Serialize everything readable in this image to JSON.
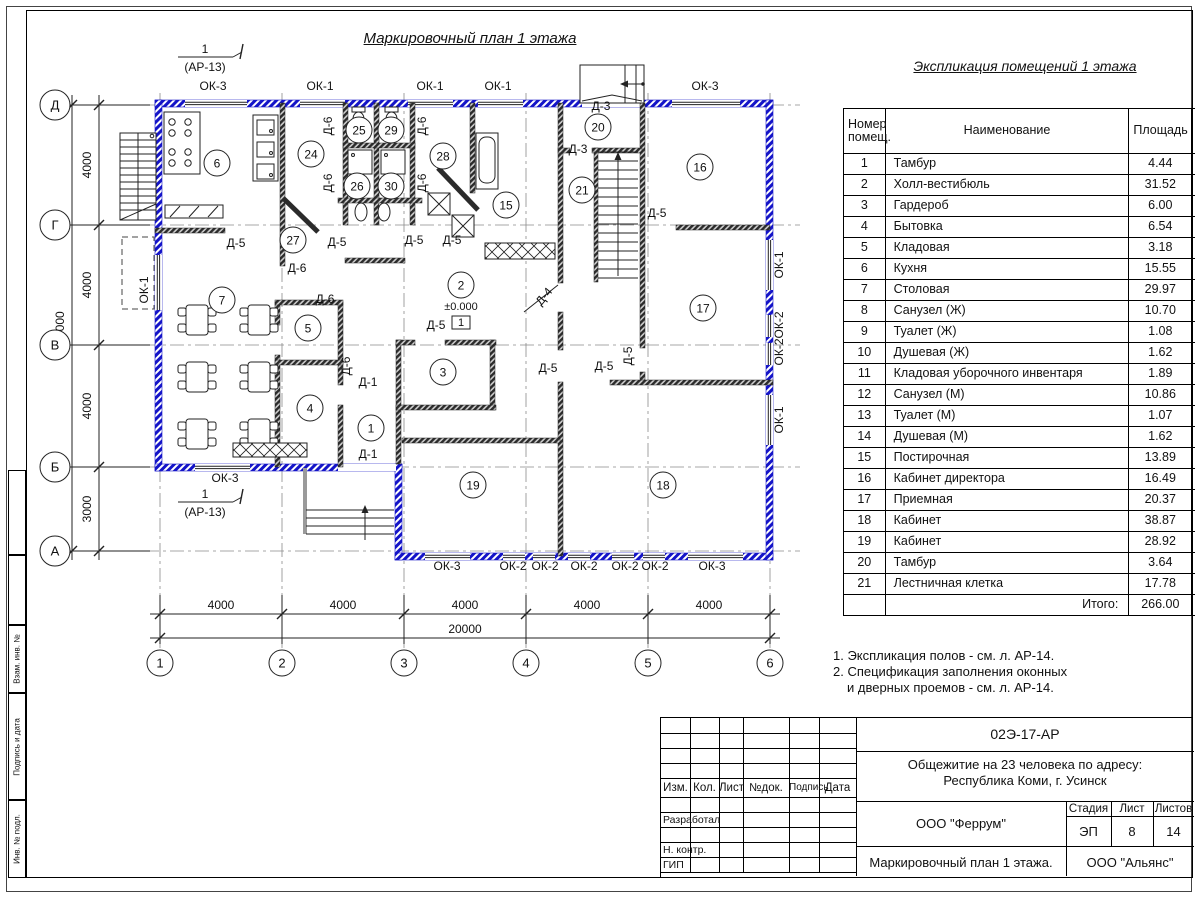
{
  "sheet": {
    "plan_title": "Маркировочный план 1 этажа",
    "section_marker": {
      "num": "1",
      "ref": "(АР-13)"
    }
  },
  "colors": {
    "exterior_wall": "#1414c8",
    "interior_wall": "#2b2b2b"
  },
  "plan": {
    "grid_cols": [
      "1",
      "2",
      "3",
      "4",
      "5",
      "6"
    ],
    "grid_rows": [
      "Д",
      "Г",
      "В",
      "Б",
      "А"
    ],
    "dims_bottom": [
      "4000",
      "4000",
      "4000",
      "4000",
      "4000"
    ],
    "dim_bottom_total": "20000",
    "dims_left": [
      "4000",
      "4000",
      "4000",
      "3000"
    ],
    "dim_left_total": "15000",
    "elevation": "±0.000",
    "floor_type_mark": "1",
    "rooms": [
      {
        "n": "1",
        "x": 371,
        "y": 428
      },
      {
        "n": "2",
        "x": 461,
        "y": 285
      },
      {
        "n": "3",
        "x": 443,
        "y": 372
      },
      {
        "n": "4",
        "x": 310,
        "y": 408
      },
      {
        "n": "5",
        "x": 308,
        "y": 328
      },
      {
        "n": "6",
        "x": 217,
        "y": 163
      },
      {
        "n": "7",
        "x": 222,
        "y": 300
      },
      {
        "n": "15",
        "x": 506,
        "y": 205
      },
      {
        "n": "16",
        "x": 700,
        "y": 167
      },
      {
        "n": "17",
        "x": 703,
        "y": 308
      },
      {
        "n": "18",
        "x": 663,
        "y": 485
      },
      {
        "n": "19",
        "x": 473,
        "y": 485
      },
      {
        "n": "20",
        "x": 598,
        "y": 127
      },
      {
        "n": "21",
        "x": 582,
        "y": 190
      },
      {
        "n": "24",
        "x": 311,
        "y": 154
      },
      {
        "n": "25",
        "x": 359,
        "y": 130
      },
      {
        "n": "26",
        "x": 357,
        "y": 186
      },
      {
        "n": "27",
        "x": 293,
        "y": 240
      },
      {
        "n": "28",
        "x": 443,
        "y": 156
      },
      {
        "n": "29",
        "x": 391,
        "y": 130
      },
      {
        "n": "30",
        "x": 391,
        "y": 186
      }
    ],
    "window_labels": [
      {
        "t": "ОК-3",
        "x": 213,
        "y": 90
      },
      {
        "t": "ОК-1",
        "x": 320,
        "y": 90
      },
      {
        "t": "ОК-1",
        "x": 430,
        "y": 90
      },
      {
        "t": "ОК-1",
        "x": 498,
        "y": 90
      },
      {
        "t": "ОК-3",
        "x": 705,
        "y": 90
      },
      {
        "t": "ОК-3",
        "x": 225,
        "y": 482
      },
      {
        "t": "ОК-3",
        "x": 447,
        "y": 570
      },
      {
        "t": "ОК-2",
        "x": 513,
        "y": 570
      },
      {
        "t": "ОК-2",
        "x": 545,
        "y": 570
      },
      {
        "t": "ОК-2",
        "x": 584,
        "y": 570
      },
      {
        "t": "ОК-2",
        "x": 625,
        "y": 570
      },
      {
        "t": "ОК-2",
        "x": 655,
        "y": 570
      },
      {
        "t": "ОК-3",
        "x": 712,
        "y": 570
      },
      {
        "t": "ОК-1",
        "x": 783,
        "y": 265,
        "r": -90
      },
      {
        "t": "ОК-2",
        "x": 783,
        "y": 325,
        "r": -90
      },
      {
        "t": "ОК-2",
        "x": 783,
        "y": 352,
        "r": -90
      },
      {
        "t": "ОК-1",
        "x": 783,
        "y": 420,
        "r": -90
      },
      {
        "t": "ОК-1",
        "x": 148,
        "y": 290,
        "r": -90
      }
    ],
    "door_labels": [
      {
        "t": "Д-6",
        "x": 332,
        "y": 126,
        "r": -90
      },
      {
        "t": "Д-6",
        "x": 426,
        "y": 126,
        "r": -90
      },
      {
        "t": "Д-6",
        "x": 332,
        "y": 183,
        "r": -90
      },
      {
        "t": "Д-6",
        "x": 426,
        "y": 183,
        "r": -90
      },
      {
        "t": "Д-6",
        "x": 350,
        "y": 366,
        "r": -90
      },
      {
        "t": "Д-6",
        "x": 297,
        "y": 272
      },
      {
        "t": "Д-6",
        "x": 325,
        "y": 303
      },
      {
        "t": "Д-5",
        "x": 236,
        "y": 247
      },
      {
        "t": "Д-5",
        "x": 337,
        "y": 246
      },
      {
        "t": "Д-5",
        "x": 414,
        "y": 244
      },
      {
        "t": "Д-5",
        "x": 452,
        "y": 244
      },
      {
        "t": "Д-5",
        "x": 436,
        "y": 329
      },
      {
        "t": "Д-5",
        "x": 548,
        "y": 372
      },
      {
        "t": "Д-5",
        "x": 604,
        "y": 370
      },
      {
        "t": "Д-5",
        "x": 657,
        "y": 217
      },
      {
        "t": "Д-5",
        "x": 632,
        "y": 356,
        "r": -90
      },
      {
        "t": "Д-3",
        "x": 601,
        "y": 110
      },
      {
        "t": "Д-3",
        "x": 578,
        "y": 153
      },
      {
        "t": "Д-4",
        "x": 547,
        "y": 299,
        "r": -50
      },
      {
        "t": "Д-1",
        "x": 368,
        "y": 386
      },
      {
        "t": "Д-1",
        "x": 368,
        "y": 458
      }
    ]
  },
  "schedule": {
    "title": "Экспликация помещений 1 этажа",
    "headers": {
      "col1a": "Номер",
      "col1b": "помещ.",
      "col2": "Наименование",
      "col3": "Площадь",
      "col4a": "Ка",
      "col4b": "по"
    },
    "rows": [
      {
        "n": "1",
        "name": "Тамбур",
        "area": "4.44"
      },
      {
        "n": "2",
        "name": "Холл-вестибюль",
        "area": "31.52"
      },
      {
        "n": "3",
        "name": "Гардероб",
        "area": "6.00"
      },
      {
        "n": "4",
        "name": "Бытовка",
        "area": "6.54"
      },
      {
        "n": "5",
        "name": "Кладовая",
        "area": "3.18"
      },
      {
        "n": "6",
        "name": "Кухня",
        "area": "15.55"
      },
      {
        "n": "7",
        "name": "Столовая",
        "area": "29.97"
      },
      {
        "n": "8",
        "name": "Санузел (Ж)",
        "area": "10.70"
      },
      {
        "n": "9",
        "name": "Туалет (Ж)",
        "area": "1.08"
      },
      {
        "n": "10",
        "name": "Душевая (Ж)",
        "area": "1.62"
      },
      {
        "n": "11",
        "name": "Кладовая уборочного инвентаря",
        "area": "1.89"
      },
      {
        "n": "12",
        "name": "Санузел (М)",
        "area": "10.86"
      },
      {
        "n": "13",
        "name": "Туалет (М)",
        "area": "1.07"
      },
      {
        "n": "14",
        "name": "Душевая (М)",
        "area": "1.62"
      },
      {
        "n": "15",
        "name": "Постирочная",
        "area": "13.89"
      },
      {
        "n": "16",
        "name": "Кабинет директора",
        "area": "16.49"
      },
      {
        "n": "17",
        "name": "Приемная",
        "area": "20.37"
      },
      {
        "n": "18",
        "name": "Кабинет",
        "area": "38.87"
      },
      {
        "n": "19",
        "name": "Кабинет",
        "area": "28.92"
      },
      {
        "n": "20",
        "name": "Тамбур",
        "area": "3.64"
      },
      {
        "n": "21",
        "name": "Лестничная клетка",
        "area": "17.78"
      }
    ],
    "total_label": "Итого:",
    "total": "266.00"
  },
  "notes": [
    "1. Экспликация полов - см. л. АР-14.",
    "2. Спецификация заполнения оконных",
    "и дверных проемов - см. л. АР-14."
  ],
  "titleblock": {
    "doc": "02Э-17-АР",
    "object1": "Общежитие на 23 человека по адресу:",
    "object2": "Республика Коми, г. Усинск",
    "designer": "ООО \"Феррум\"",
    "stage_label": "Стадия",
    "sheet_label": "Лист",
    "sheets_label": "Листов",
    "stage": "ЭП",
    "sheet": "8",
    "sheets": "14",
    "drawing": "Маркировочный план 1 этажа.",
    "contractor": "ООО \"Альянс\"",
    "cols": [
      "Изм.",
      "Кол.",
      "Лист",
      "№док.",
      "Подпись",
      "Дата"
    ],
    "rows": [
      "Разработал",
      "Н. контр.",
      "ГИП"
    ]
  },
  "margin_labels": [
    "Взам. инв. №",
    "Подпись и дата",
    "Инв. № подл."
  ]
}
